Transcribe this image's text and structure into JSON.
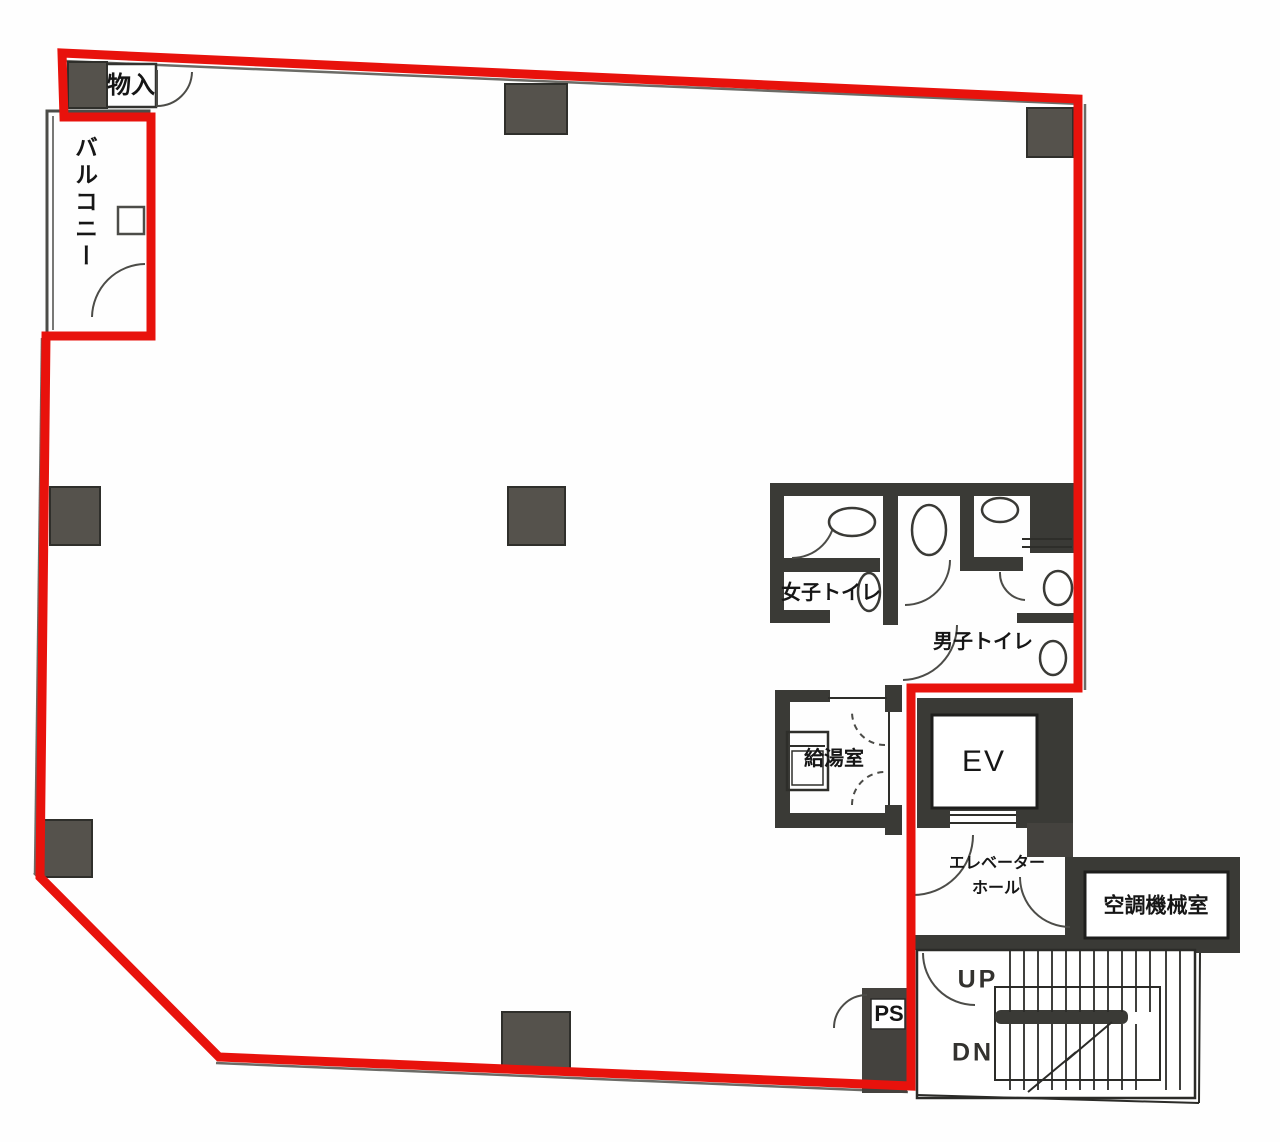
{
  "document": {
    "type": "building-floor-plan",
    "language": "ja"
  },
  "labels": {
    "storage": "物入",
    "balcony": "バルコニー",
    "womens_toilet": "女子トイレ",
    "mens_toilet": "男子トイレ",
    "kitchenette": "給湯室",
    "elevator": "EV",
    "elevator_hall_1": "エレベーター",
    "elevator_hall_2": "ホール",
    "hvac_room": "空調機械室",
    "pipe_space": "PS",
    "stairs_up": "UP",
    "stairs_down": "DN"
  },
  "colors": {
    "lease_boundary": "#e8120c",
    "wall": "#3a3a36",
    "column": "#55524c",
    "thin_line": "#2e2e2a",
    "floor": "#ffffff"
  }
}
